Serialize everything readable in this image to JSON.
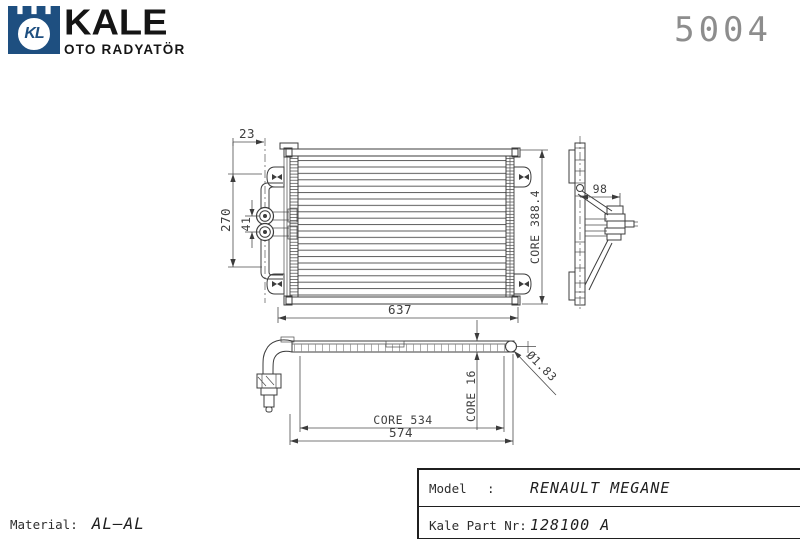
{
  "brand": {
    "logo_initials": "KL",
    "name": "KALE",
    "subtitle": "OTO RADYATÖR"
  },
  "drawing_number": "5004",
  "dimensions": {
    "front": {
      "pipe_offset": "23",
      "bracket_span": "270",
      "pipe_spacing": "41",
      "overall_width": "637",
      "core_height": "CORE 388.4"
    },
    "side": {
      "depth": "98"
    },
    "bottom": {
      "core_width": "CORE 534",
      "overall_width": "574",
      "core_thickness": "CORE 16",
      "pin_diameter": "Ø1.83"
    }
  },
  "footer": {
    "material_label": "Material:",
    "material_value": "AL–AL",
    "spec_table": {
      "rows": [
        {
          "label": "Model",
          "separator": ":",
          "value": "RENAULT MEGANE"
        },
        {
          "label": "Kale Part Nr:",
          "separator": "",
          "value": "128100 A"
        }
      ]
    }
  },
  "colors": {
    "brand_blue": "#1e4f80",
    "line": "#3c3c3c",
    "dim_text": "#3f3f3f",
    "number_gray": "#8d8d8d"
  }
}
